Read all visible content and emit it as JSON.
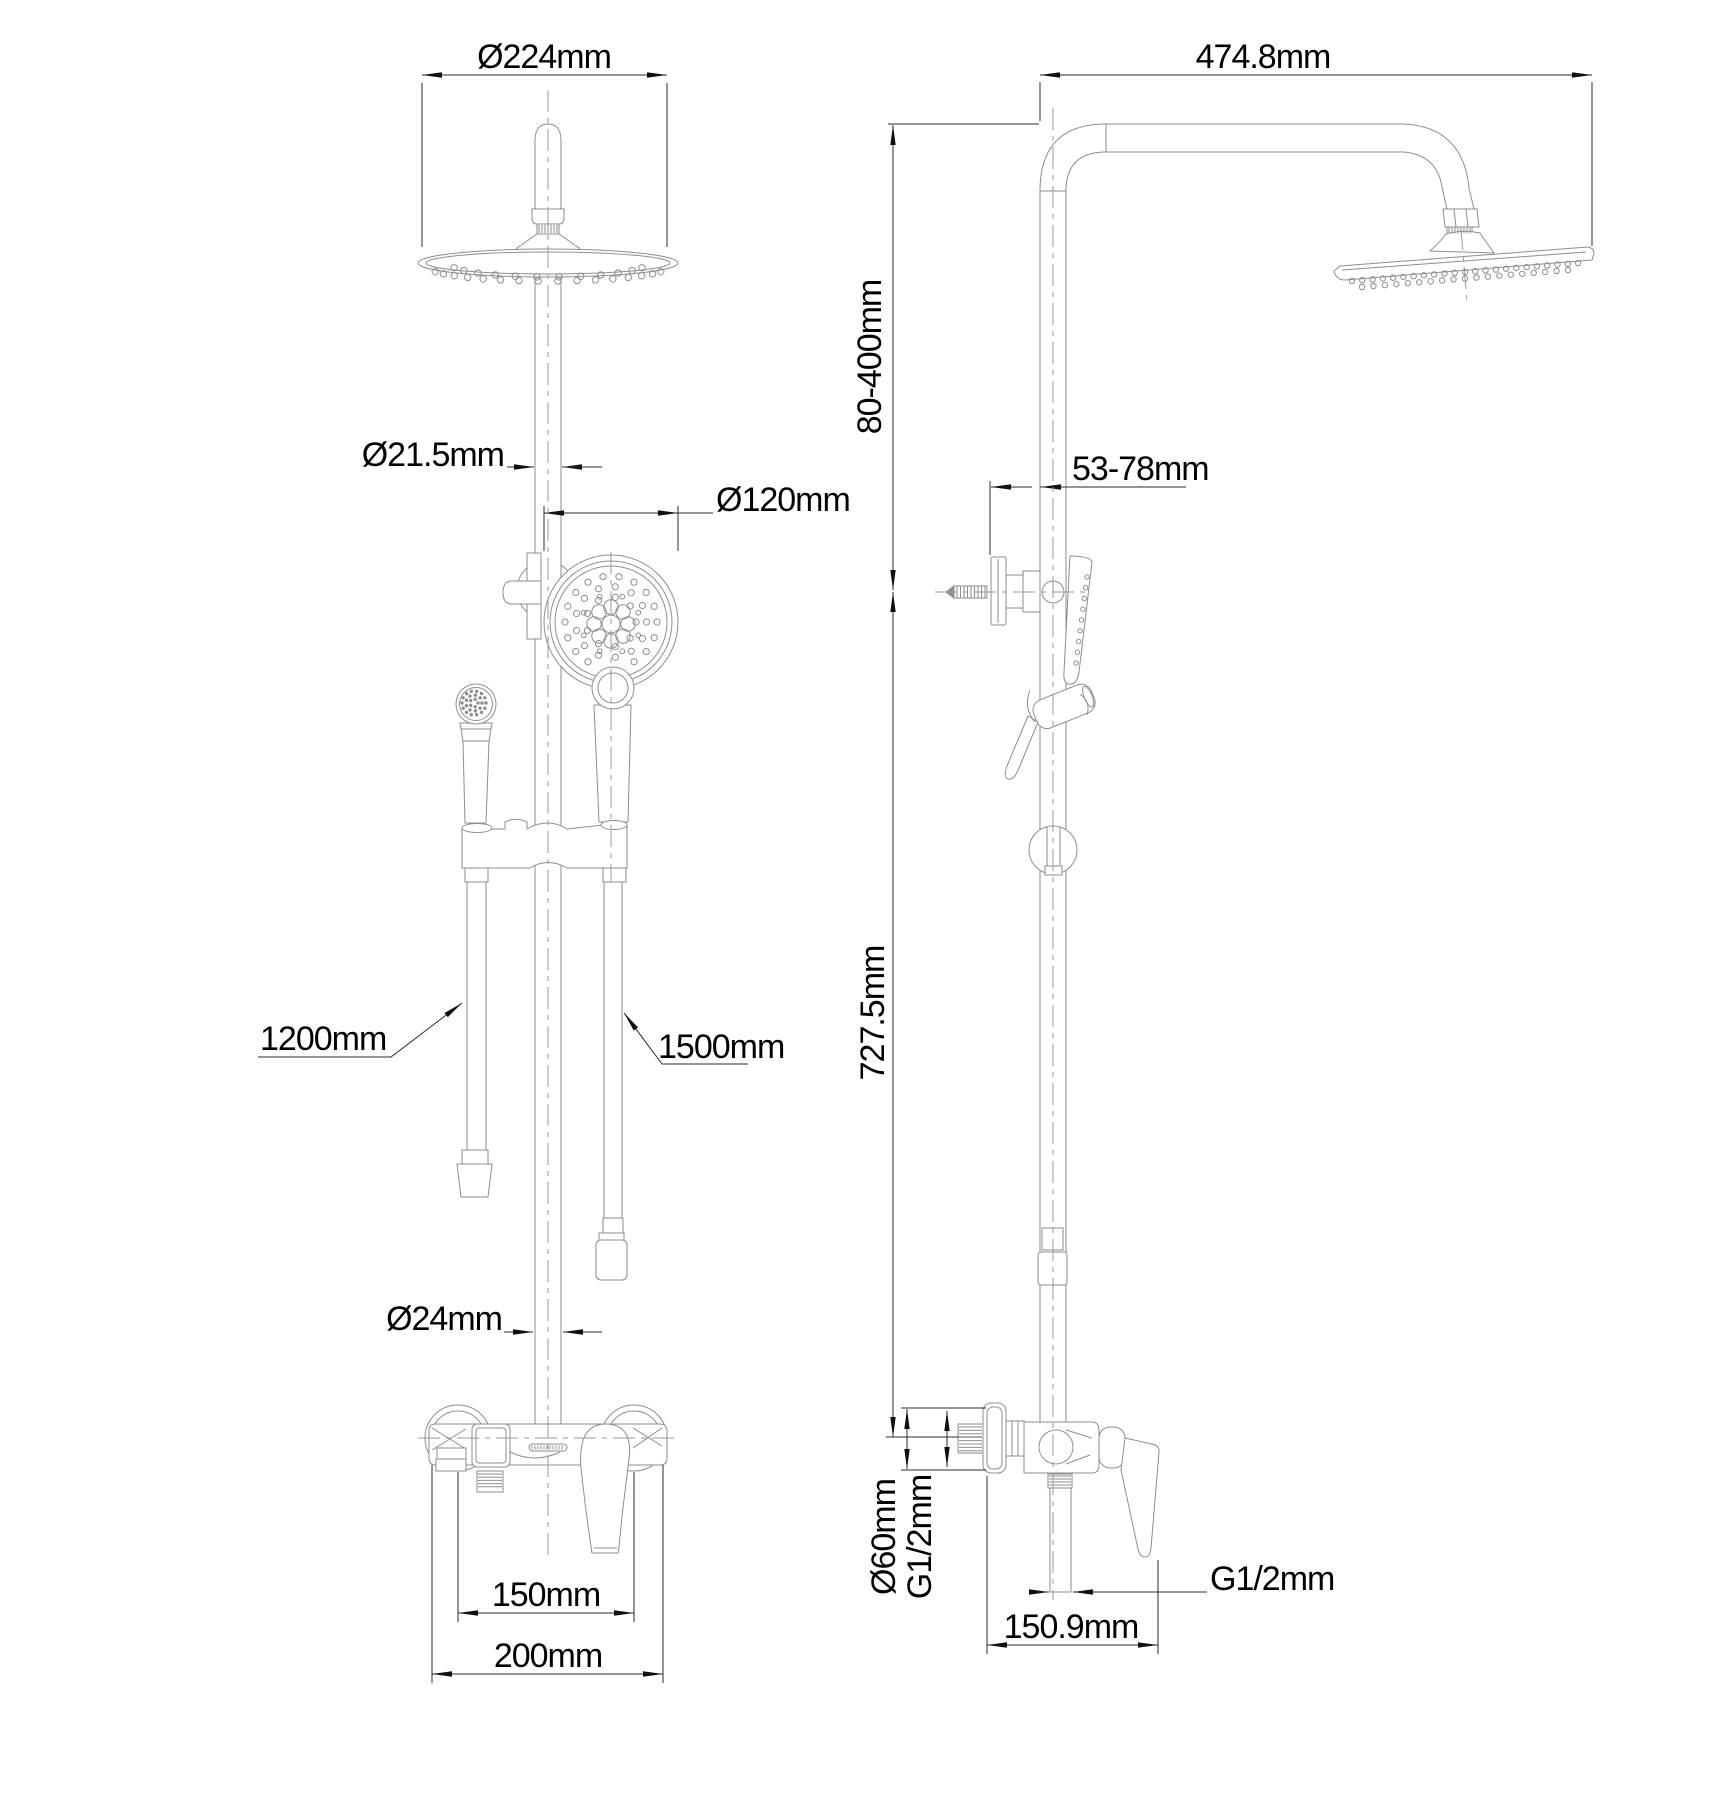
{
  "front_view": {
    "head_diameter": "Ø224mm",
    "riser_upper_diameter": "Ø21.5mm",
    "hand_shower_diameter": "Ø120mm",
    "left_hose_length": "1200mm",
    "right_hose_length": "1500mm",
    "riser_lower_diameter": "Ø24mm",
    "inlet_spacing": "150mm",
    "body_width": "200mm"
  },
  "side_view": {
    "arm_reach": "474.8mm",
    "height_adjust_range": "80-400mm",
    "wall_clearance_range": "53-78mm",
    "riser_height": "727.5mm",
    "escutcheon_diameter": "Ø60mm",
    "inlet_thread": "G1/2mm",
    "outlet_thread": "G1/2mm",
    "valve_depth": "150.9mm"
  }
}
